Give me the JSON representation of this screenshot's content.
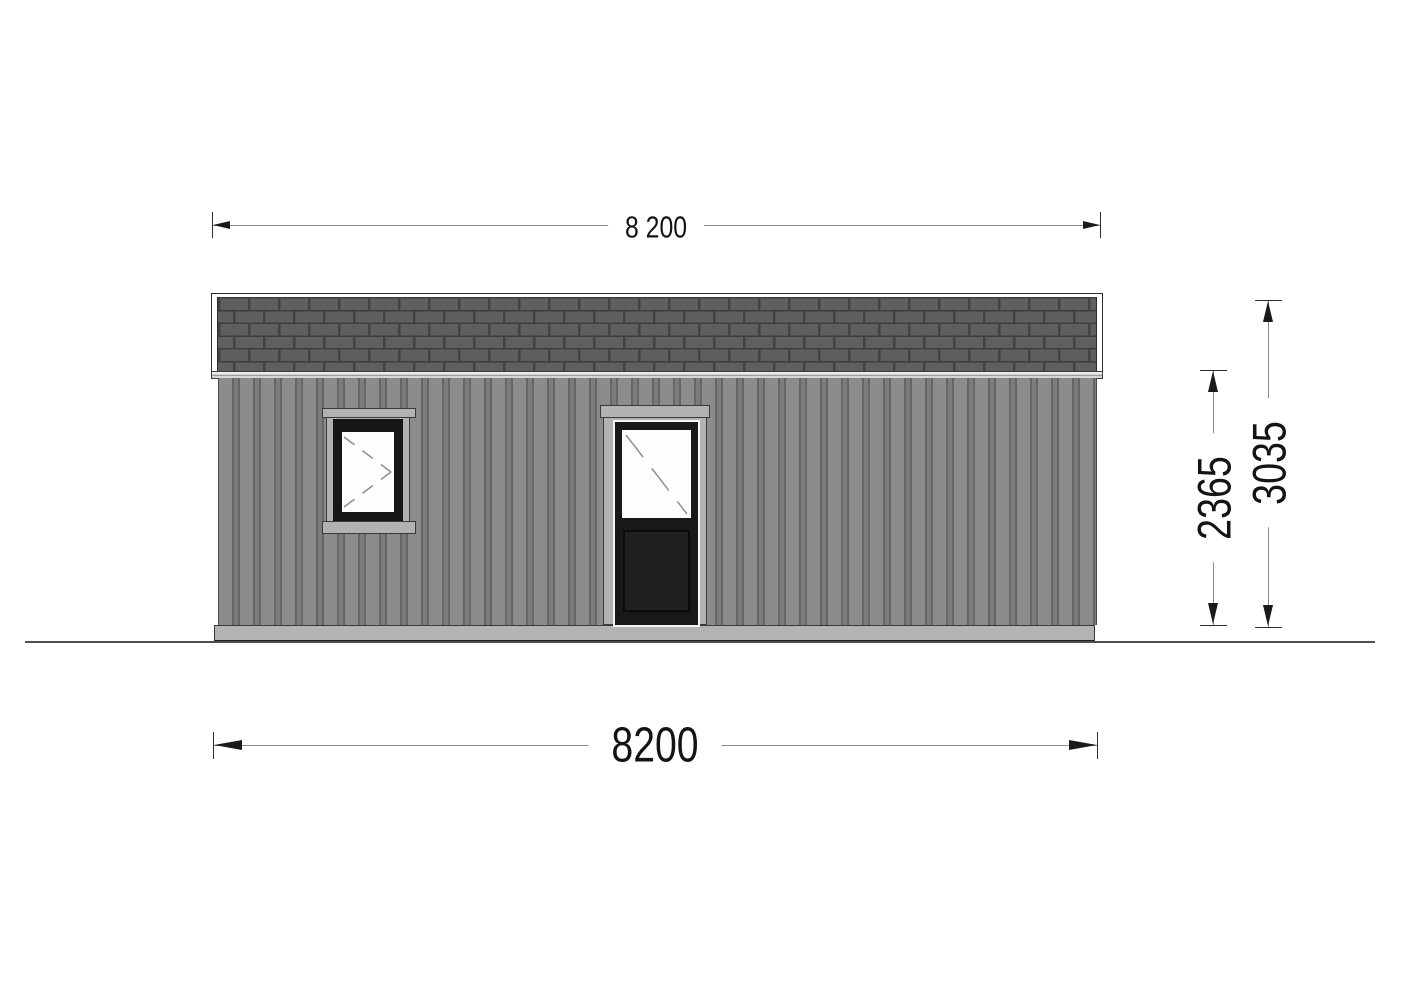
{
  "page": {
    "type": "architectural-elevation-drawing",
    "background": "#ffffff"
  },
  "dimensions": {
    "top_width": {
      "value": "8 200"
    },
    "bottom_width": {
      "value": "8200"
    },
    "wall_height": {
      "value": "2365"
    },
    "total_height": {
      "value": "3035"
    }
  },
  "elevation": {
    "elements": [
      "roof-shingles",
      "roof-fascia",
      "wall-siding",
      "window",
      "door",
      "foundation-base",
      "ground-line"
    ],
    "colors": {
      "shingle": "#5f5f5f",
      "shingle_joint": "#3e3e3e",
      "wall": "#8c8c8c",
      "wall_stripe": "#666666",
      "trim": "#b2b2b2",
      "frame": "#181818",
      "glass": "#fdfdfd",
      "foundation": "#b3b3b3",
      "ground_line": "#4f4f4f",
      "dimension_text": "#141414"
    }
  }
}
